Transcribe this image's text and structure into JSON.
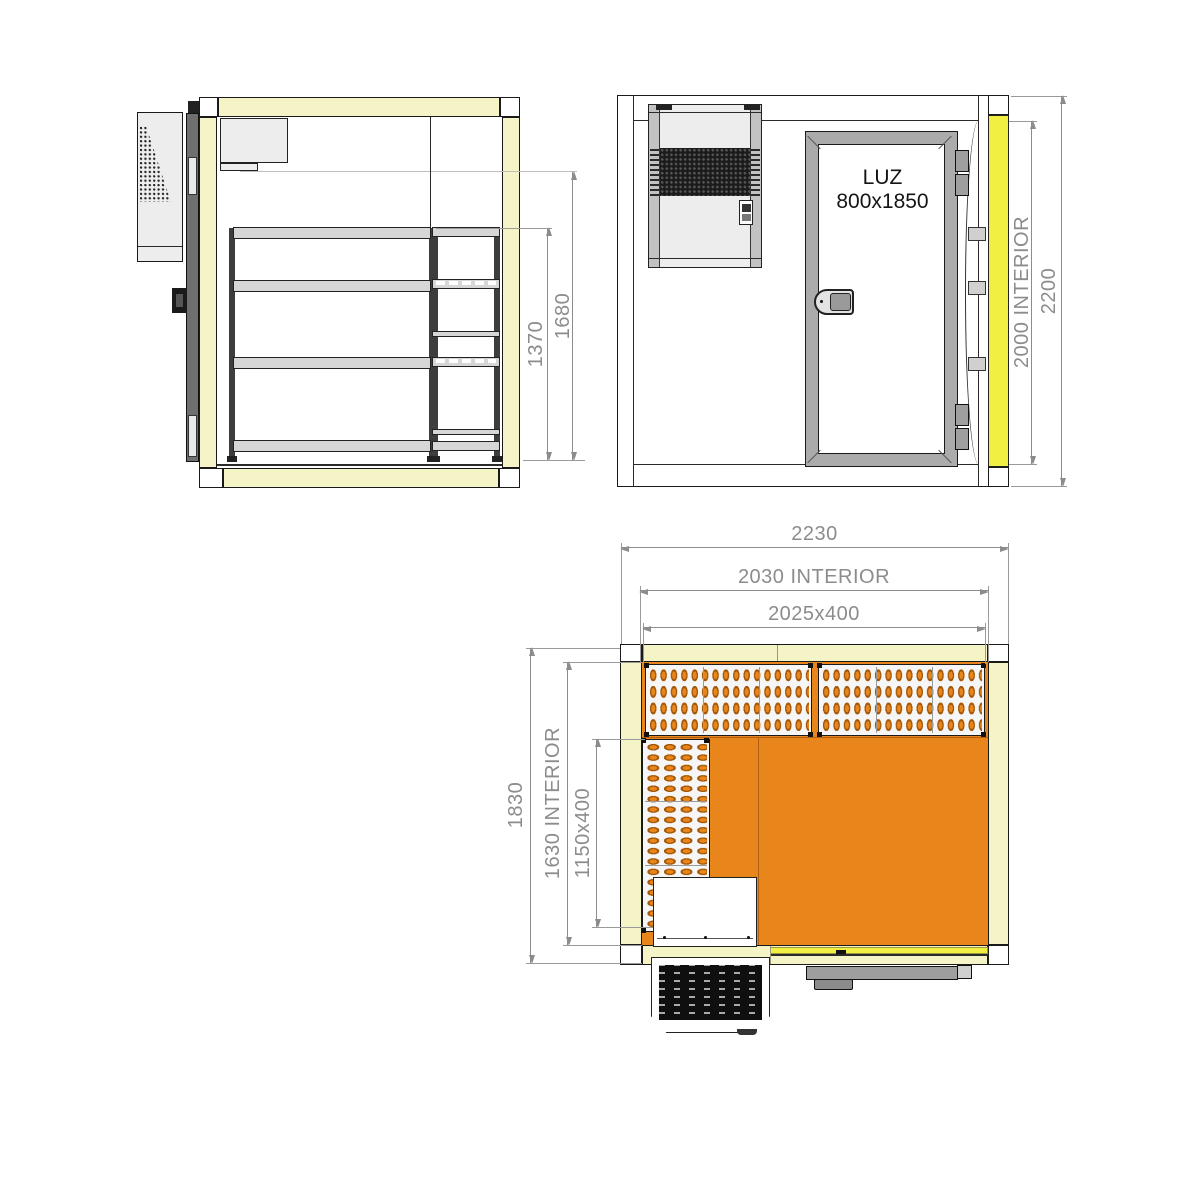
{
  "colors": {
    "wall": "#F4F4C6",
    "accent": "#F1EF41",
    "floor": "#E8861C",
    "slotb": "#A35708",
    "line": "#1a1a1a",
    "dim": "#8c8c8c",
    "unit": "#ededed",
    "doorframe": "#ababab"
  },
  "views": {
    "side": {
      "dims": {
        "d1370": "1370",
        "d1680": "1680"
      }
    },
    "front": {
      "door_label1": "LUZ",
      "door_label2": "800x1850",
      "dims": {
        "interior_height": "2000 INTERIOR",
        "total_height": "2200"
      }
    },
    "plan": {
      "dims": {
        "total_width": "2230",
        "interior_width": "2030 INTERIOR",
        "back_shelf": "2025x400",
        "total_depth": "1830",
        "interior_depth": "1630 INTERIOR",
        "side_shelf": "1150x400"
      }
    }
  }
}
